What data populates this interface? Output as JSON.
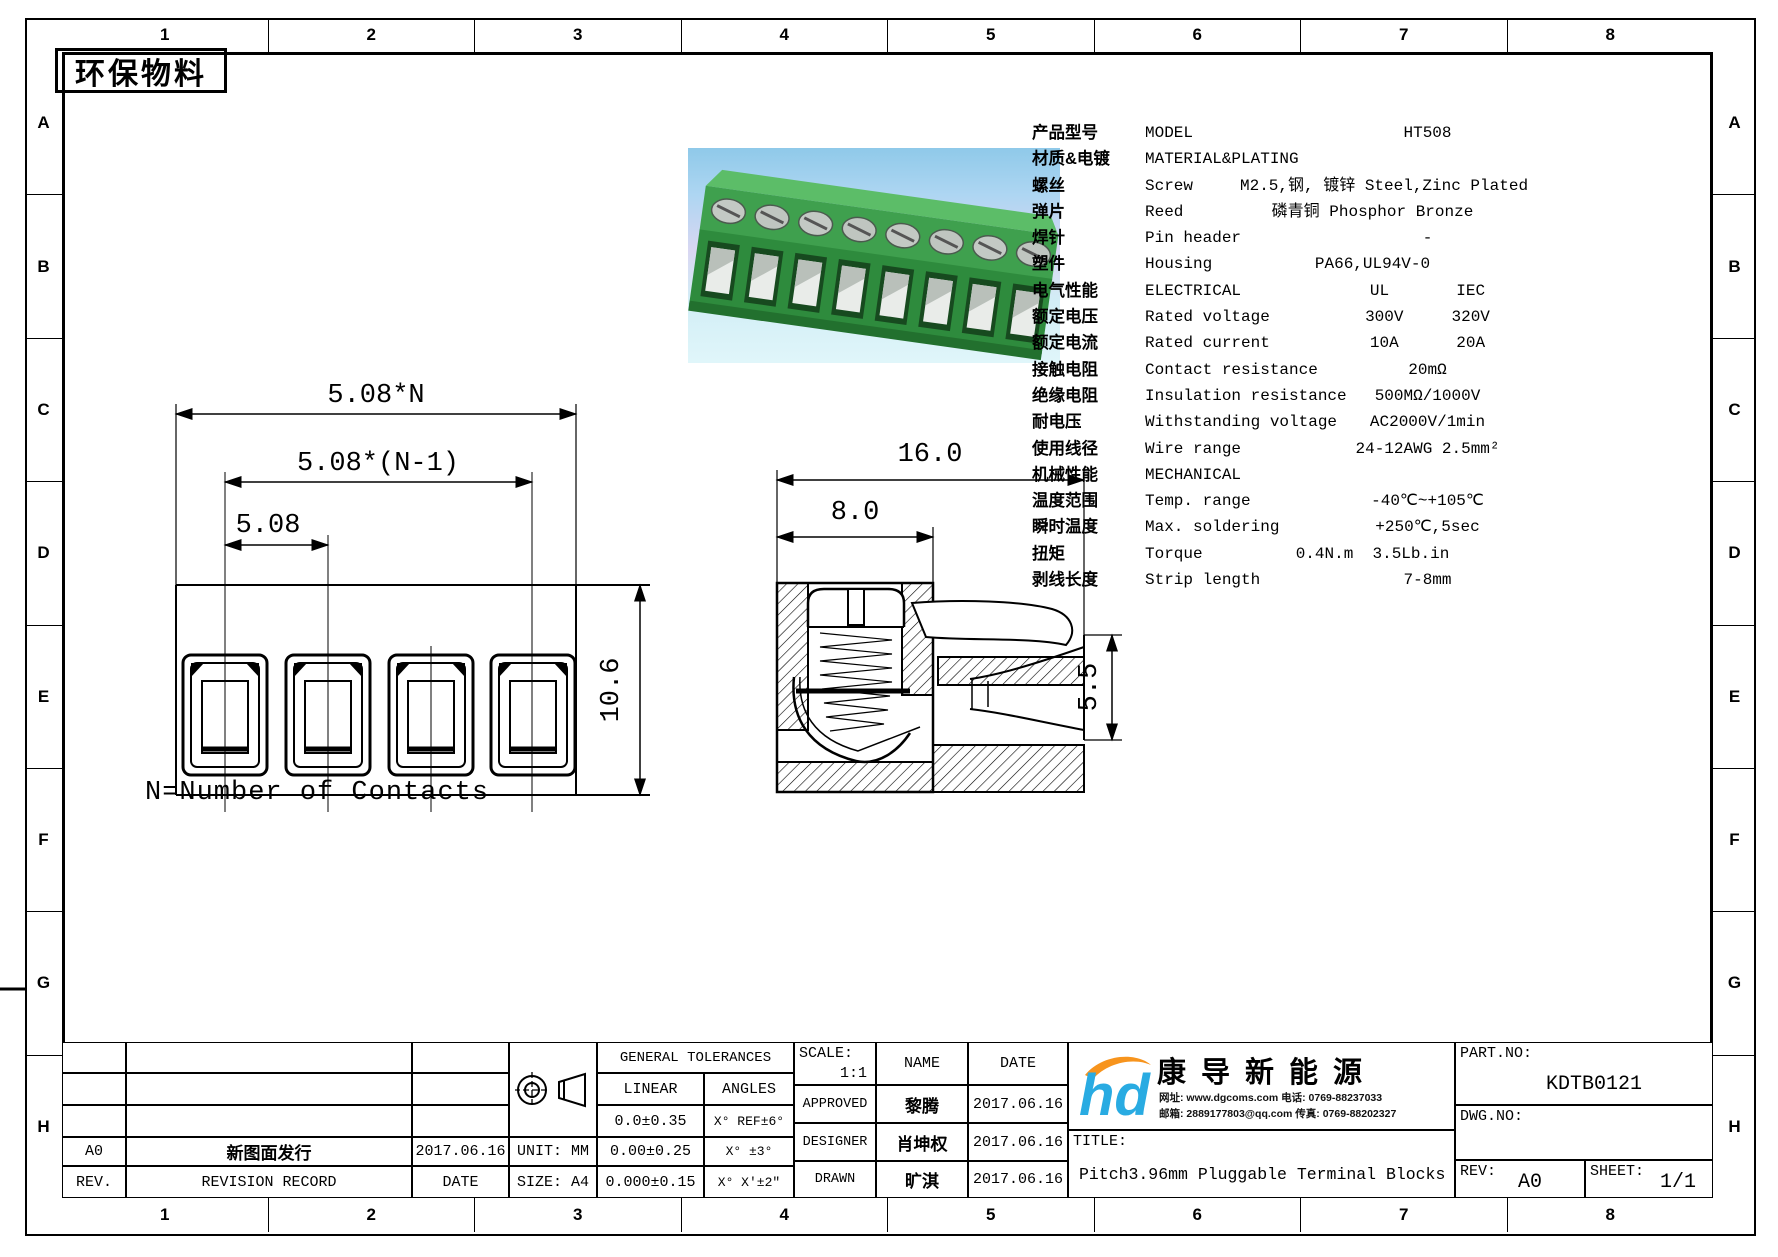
{
  "sheet": {
    "eco_label": "环保物料",
    "note": "N=Number of Contacts",
    "zone_numbers": [
      "1",
      "2",
      "3",
      "4",
      "5",
      "6",
      "7",
      "8"
    ],
    "zone_letters": [
      "A",
      "B",
      "C",
      "D",
      "E",
      "F",
      "G",
      "H"
    ]
  },
  "specs": {
    "rows": [
      {
        "cn": "产品型号",
        "en": "MODEL",
        "val": "HT508"
      },
      {
        "cn": "材质&电镀",
        "en": "MATERIAL&PLATING",
        "val": ""
      },
      {
        "cn": "螺丝",
        "en": "Screw",
        "val": "M2.5,钢, 镀锌 Steel,Zinc Plated"
      },
      {
        "cn": "弹片",
        "en": "Reed",
        "val": "磷青铜 Phosphor Bronze"
      },
      {
        "cn": "焊针",
        "en": "Pin header",
        "val": "-"
      },
      {
        "cn": "塑件",
        "en": "Housing",
        "val": "PA66,UL94V-0"
      },
      {
        "cn": "电气性能",
        "en": "ELECTRICAL",
        "val": "UL       IEC"
      },
      {
        "cn": "额定电压",
        "en": "Rated voltage",
        "val": "300V     320V"
      },
      {
        "cn": "额定电流",
        "en": "Rated current",
        "val": "10A      20A"
      },
      {
        "cn": "接触电阻",
        "en": "Contact resistance",
        "val": "20mΩ"
      },
      {
        "cn": "绝缘电阻",
        "en": "Insulation resistance",
        "val": "500MΩ/1000V"
      },
      {
        "cn": "耐电压",
        "en": "Withstanding voltage",
        "val": "AC2000V/1min"
      },
      {
        "cn": "使用线径",
        "en": "Wire range",
        "val": "24-12AWG 2.5mm²"
      },
      {
        "cn": "机械性能",
        "en": "MECHANICAL",
        "val": ""
      },
      {
        "cn": "温度范围",
        "en": "Temp. range",
        "val": "-40℃~+105℃"
      },
      {
        "cn": "瞬时温度",
        "en": "Max. soldering",
        "val": "+250℃,5sec"
      },
      {
        "cn": "扭矩",
        "en": "Torque",
        "val": "0.4N.m  3.5Lb.in"
      },
      {
        "cn": "剥线长度",
        "en": "Strip length",
        "val": "7-8mm"
      }
    ]
  },
  "front_view": {
    "overall": "5.08*N",
    "span": "5.08*(N-1)",
    "pitch": "5.08",
    "height": "10.6"
  },
  "section_view": {
    "width": "16.0",
    "body": "8.0",
    "opening": "5.5"
  },
  "title_block": {
    "revision_table": {
      "rev_value": "A0",
      "record_value": "新图面发行",
      "date_value": "2017.06.16",
      "rev_header": "REV.",
      "record_header": "REVISION RECORD",
      "date_header": "DATE"
    },
    "unit": "UNIT: MM",
    "size": "SIZE: A4",
    "tolerances": {
      "header": "GENERAL TOLERANCES",
      "linear_label": "LINEAR",
      "angles_label": "ANGLES",
      "rows": [
        [
          "0.0±0.35",
          "X° REF±6°"
        ],
        [
          "0.00±0.25",
          "X° ±3°"
        ],
        [
          "0.000±0.15",
          "X° X'±2\""
        ]
      ]
    },
    "approval": {
      "scale_label": "SCALE:",
      "scale": "1:1",
      "name_label": "NAME",
      "date_label": "DATE",
      "rows": [
        [
          "APPROVED",
          "黎腾",
          "2017.06.16"
        ],
        [
          "DESIGNER",
          "肖坤权",
          "2017.06.16"
        ],
        [
          "DRAWN",
          "旷淇",
          "2017.06.16"
        ]
      ]
    },
    "company": {
      "logo_text": "hd",
      "name": "康导新能源",
      "contact1": "网址: www.dgcoms.com   电话: 0769-88237033",
      "contact2": "邮箱: 2889177803@qq.com 传真: 0769-88202327"
    },
    "title_label": "TITLE:",
    "title": "Pitch3.96mm Pluggable Terminal Blocks",
    "part_no_label": "PART.NO:",
    "part_no": "KDTB0121",
    "dwg_no_label": "DWG.NO:",
    "rev_label": "REV:",
    "rev": "A0",
    "sheet_label": "SHEET:",
    "sheet": "1/1"
  }
}
